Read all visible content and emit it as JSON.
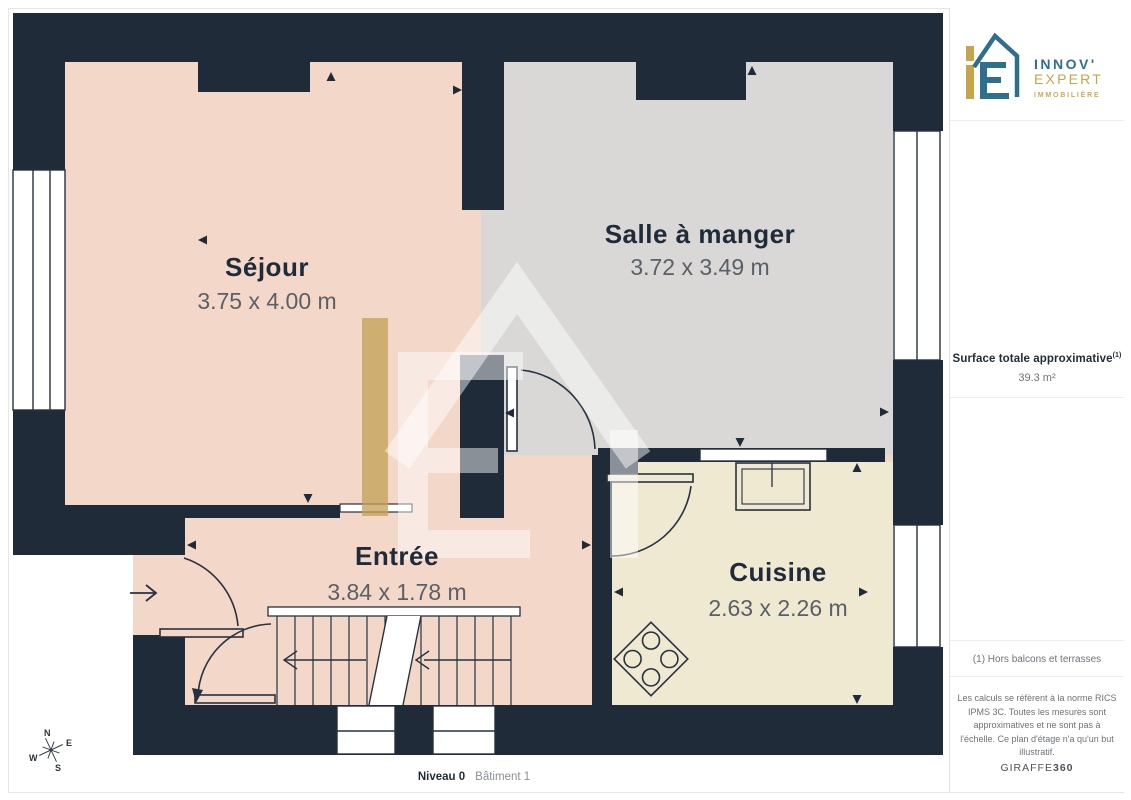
{
  "plan": {
    "level_label": "Niveau 0",
    "building_label": "Bâtiment 1",
    "wall_color": "#1f2b38",
    "rooms": [
      {
        "id": "sejour",
        "name": "Séjour",
        "dimensions": "3.75 x 4.00 m",
        "floor_color": "#f3d8ca"
      },
      {
        "id": "salle-a-manger",
        "name": "Salle à manger",
        "dimensions": "3.72 x 3.49 m",
        "floor_color": "#d9d8d6"
      },
      {
        "id": "entree",
        "name": "Entrée",
        "dimensions": "3.84 x 1.78 m",
        "floor_color": "#f3d8ca"
      },
      {
        "id": "cuisine",
        "name": "Cuisine",
        "dimensions": "2.63 x 2.26 m",
        "floor_color": "#f0e9d2"
      }
    ],
    "text_colors": {
      "room_title": "#1f2b38",
      "room_dims": "#5a6067"
    },
    "compass": {
      "n": "N",
      "e": "E",
      "s": "S",
      "w": "W"
    }
  },
  "sidebar": {
    "logo": {
      "name_top": "INNOV'",
      "name_bottom": "EXPERT",
      "tagline": "IMMOBILIÈRE",
      "blue": "#2e6f8e",
      "gold": "#c5a44c"
    },
    "surface": {
      "label": "Surface totale approximative",
      "footnote_marker": "(1)",
      "value": "39.3 m²"
    },
    "footnote": "(1) Hors balcons et terrasses",
    "disclaimer": "Les calculs se réfèrent à la norme RICS IPMS 3C. Toutes les mesures sont approximatives et ne sont pas à l'échelle. Ce plan d'étage n'a qu'un but illustratif.",
    "brand": {
      "name": "GIRAFFE",
      "suffix": "360"
    }
  }
}
